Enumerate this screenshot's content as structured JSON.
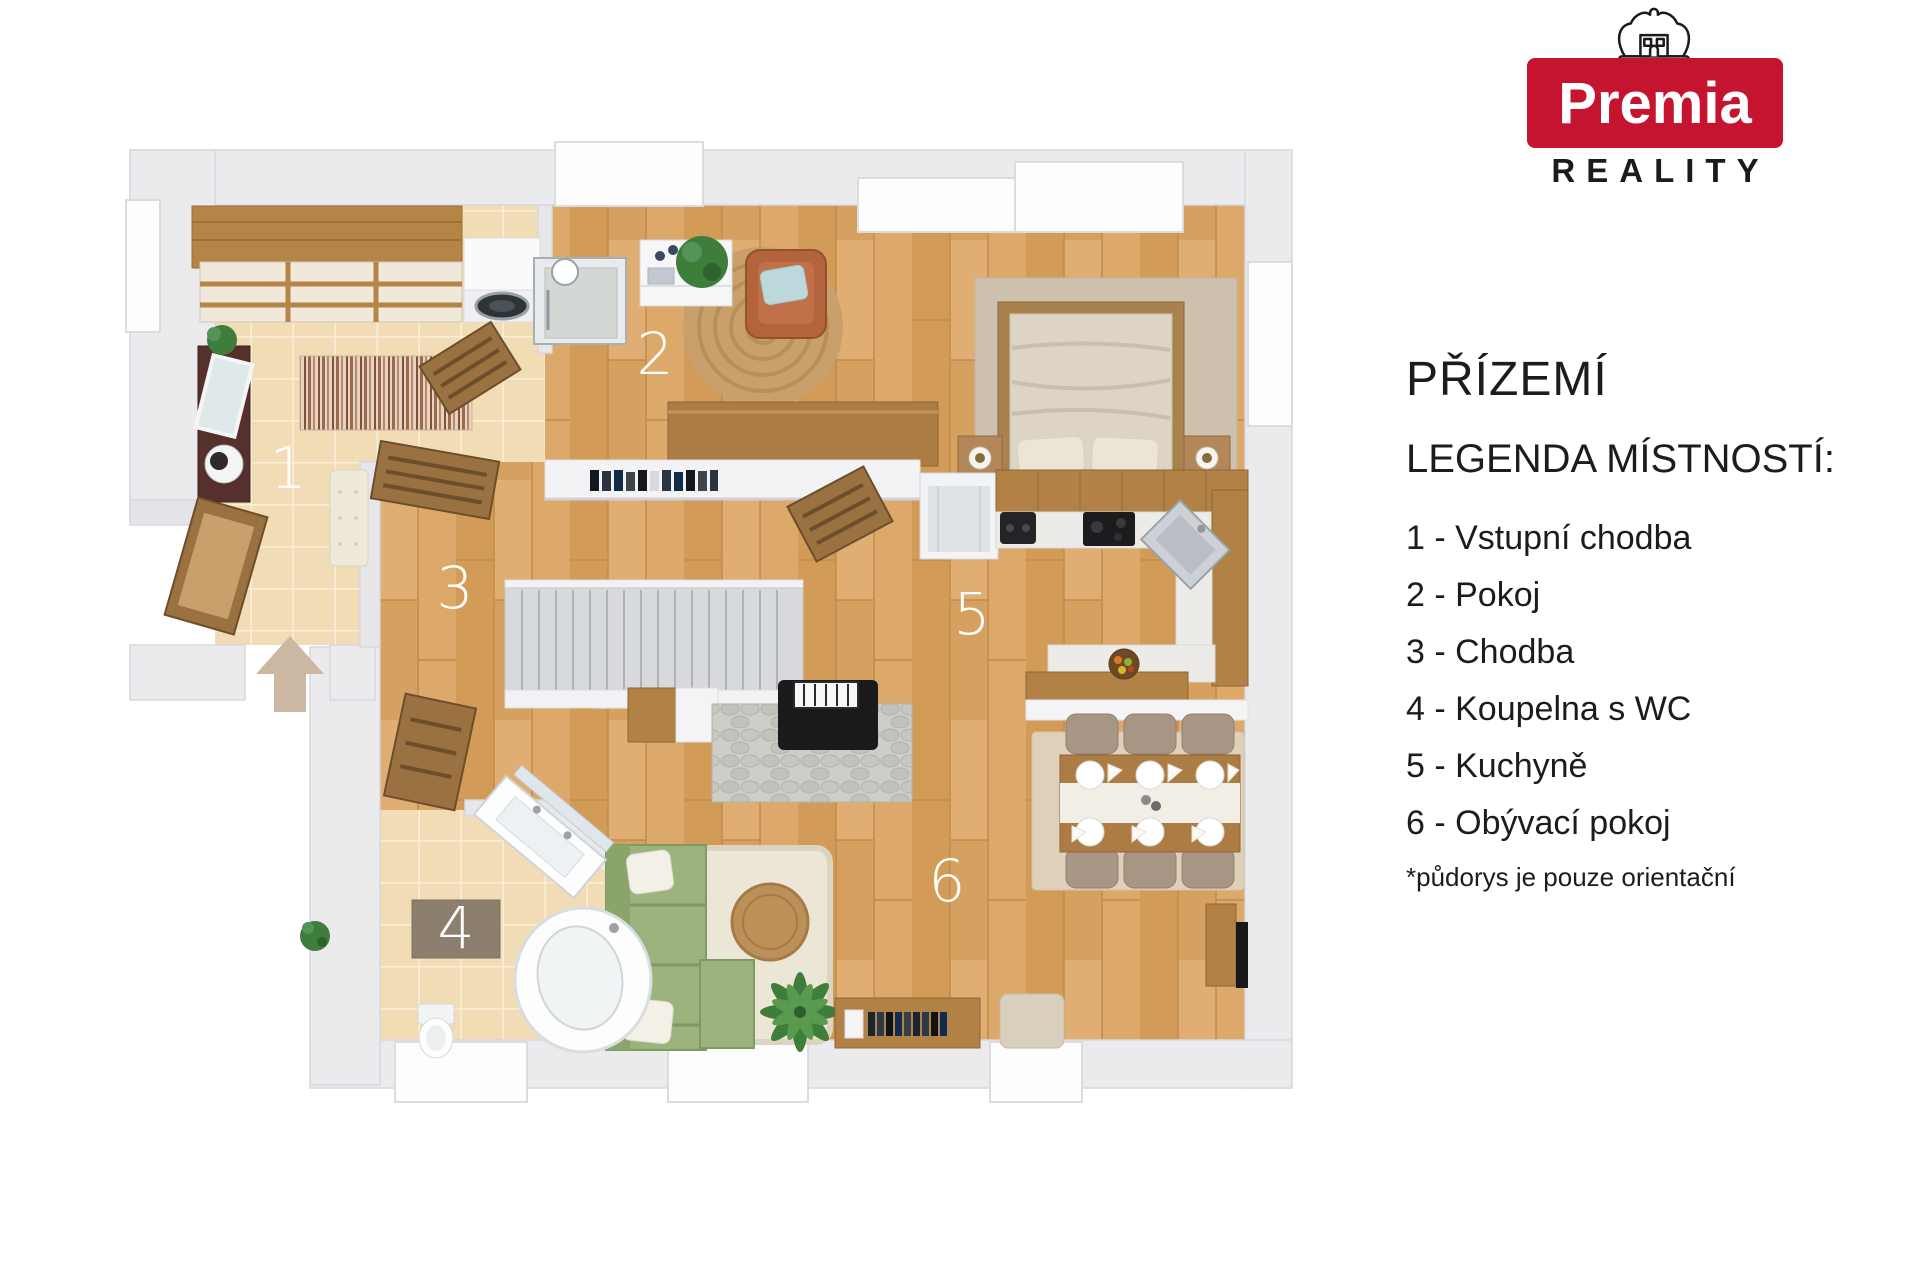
{
  "brand": {
    "name": "Premia",
    "tagline": "REALITY",
    "color": "#c41430"
  },
  "icons": {
    "logo_crown": "crown",
    "entry_arrow": "arrow-up-into-entrance"
  },
  "panel": {
    "title": "PŘÍZEMÍ",
    "legend_heading": "LEGENDA MÍSTNOSTÍ:",
    "items": [
      {
        "label": "1 - Vstupní chodba"
      },
      {
        "label": "2 - Pokoj"
      },
      {
        "label": "3 - Chodba"
      },
      {
        "label": "4 - Koupelna s WC"
      },
      {
        "label": "5 - Kuchyně"
      },
      {
        "label": "6 - Obývací pokoj"
      }
    ],
    "footnote": "*půdorys je pouze orientační"
  },
  "floorplan": {
    "labels": {
      "r1": "1",
      "r2": "2",
      "r3": "3",
      "r4": "4",
      "r5": "5",
      "r6": "6"
    },
    "colors": {
      "wall": "#ebebee",
      "wood_floor": "#d9a566",
      "tile_floor": "#f1dcb6",
      "sofa_green": "#9cb37e",
      "arrow_beige": "#cbb7a2"
    }
  }
}
